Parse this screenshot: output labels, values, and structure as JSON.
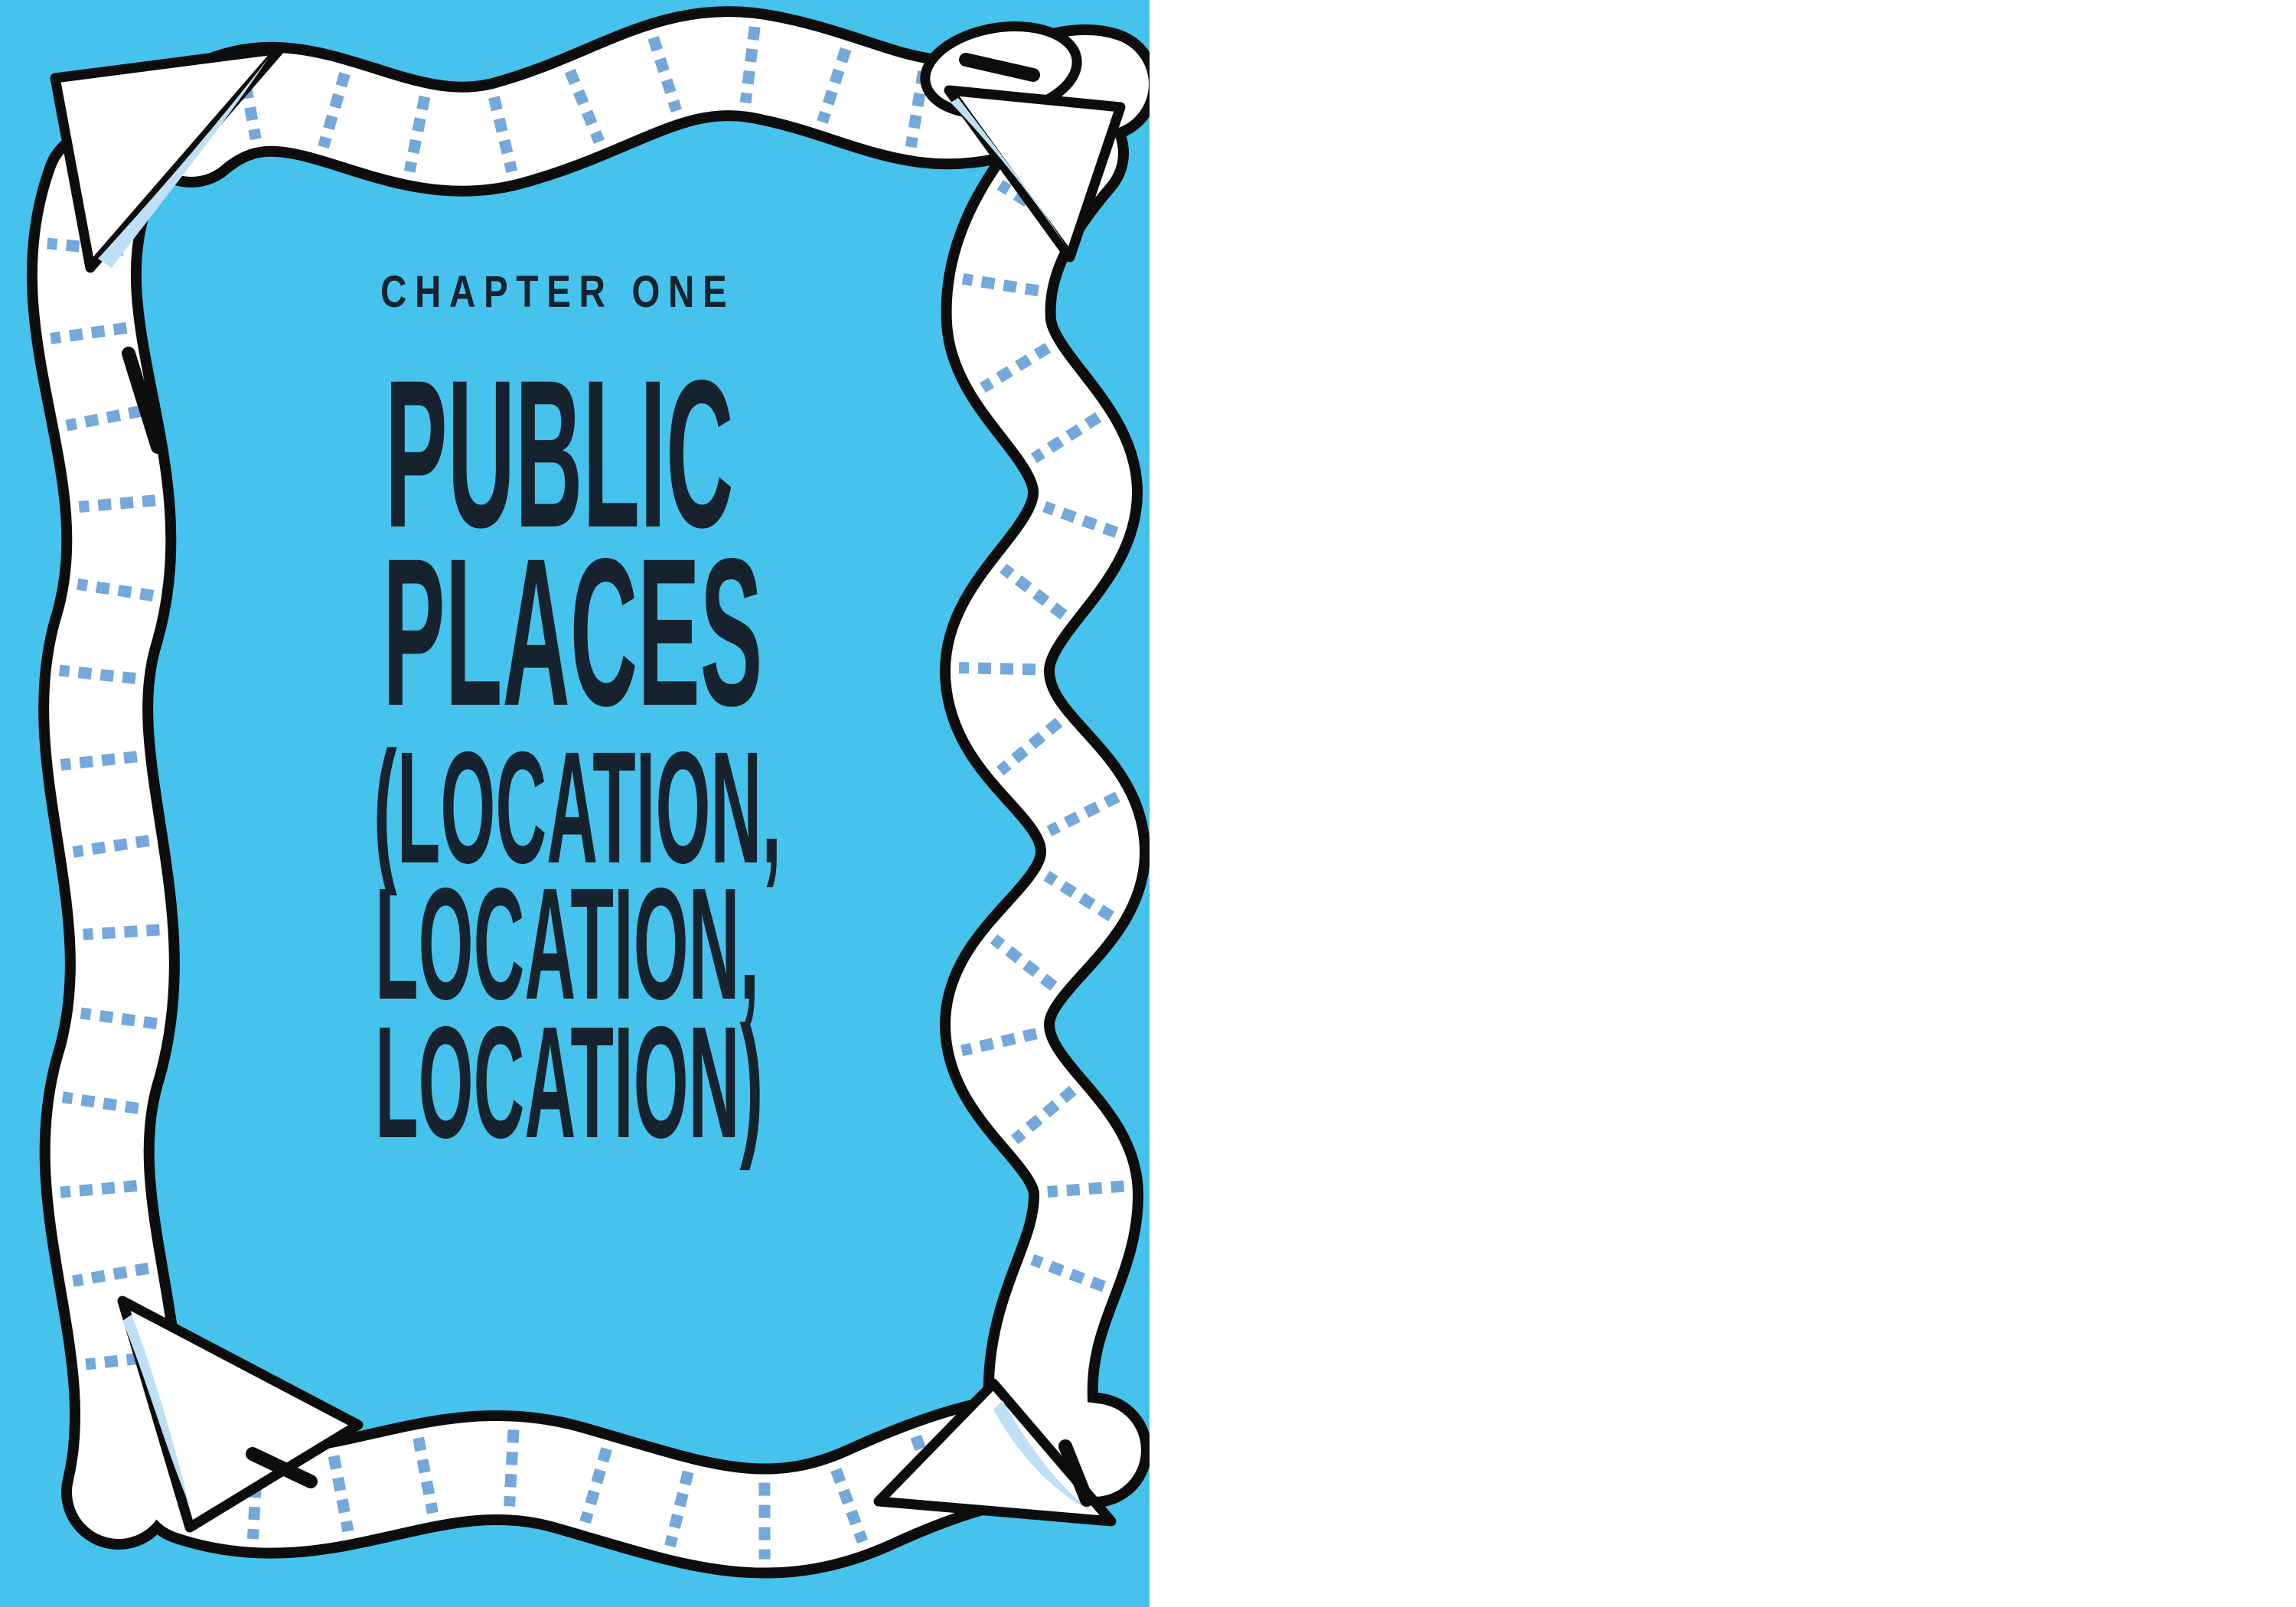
{
  "book_spread": {
    "left_page": {
      "kicker": "CHAPTER ONE",
      "title_lines": [
        "PUBLIC",
        "PLACES"
      ],
      "subtitle_lines": [
        "(LOCATION,",
        "LOCATION,",
        "LOCATION)"
      ],
      "illustration": "toilet-paper ribbon border with corner folds and perforation dashes"
    },
    "right_page": {
      "page_number": "17",
      "heading": "OUT AND ABOUT",
      "body_lines": [
        "One of the largest factors for determining the value of a",
        "piece of property is its location. This happens to also be the",
        "strongest ingredient that impacts our toilet time—where",
        "we are when nature calls our mobile line. Some toilets have",
        "a view, some have a long line, and others feel like you just",
        [
          {
            "t": "entered the Upside Down of "
          },
          {
            "t": "Stranger Things.",
            "s": "i"
          },
          {
            "t": "6",
            "s": "sup"
          },
          {
            "t": " While some"
          }
        ],
        "commode users strive to completely avoid certain toilet situa-",
        "tions, I believe you must embrace all cases and be prepared",
        "for them, because nature’s call can be unpredictable and",
        "unforgiving. This book has you covered, whether you are",
        "visiting an unfamiliar city, at work or at school, or at someone",
        "else’s house. Public restroom availability can unfortunately",
        "be a substantial problem for folks on the go. A New York",
        "City–funded report estimated in 2019 that it had a ratio of just",
        "sixteen restrooms per one hundred thousand inhabitants for",
        "its 8.5 million population (also the largest population density",
        "in the United States). London has very slightly more, with an",
        "estimated 1,500 public loos for 8 million inhabitants, accord-",
        "ing to a 2022 study (NYC’s tally is about 1,360). This doesn’t"
      ],
      "footnote_marker": "6",
      "footnote_lines": [
        "The toilet situation in the Upside Down was a deleted scene for the Blu-ray limited",
        "release."
      ]
    }
  },
  "colors": {
    "page_blue": "#45c3ec",
    "heading_blue": "#4cc1e9",
    "ink_navy": "#16222e",
    "body_text": "#323232",
    "perforation_blue": "#74a8da",
    "paper_shadow_blue": "#bfe0f4",
    "outline_black": "#0d0d0d"
  }
}
